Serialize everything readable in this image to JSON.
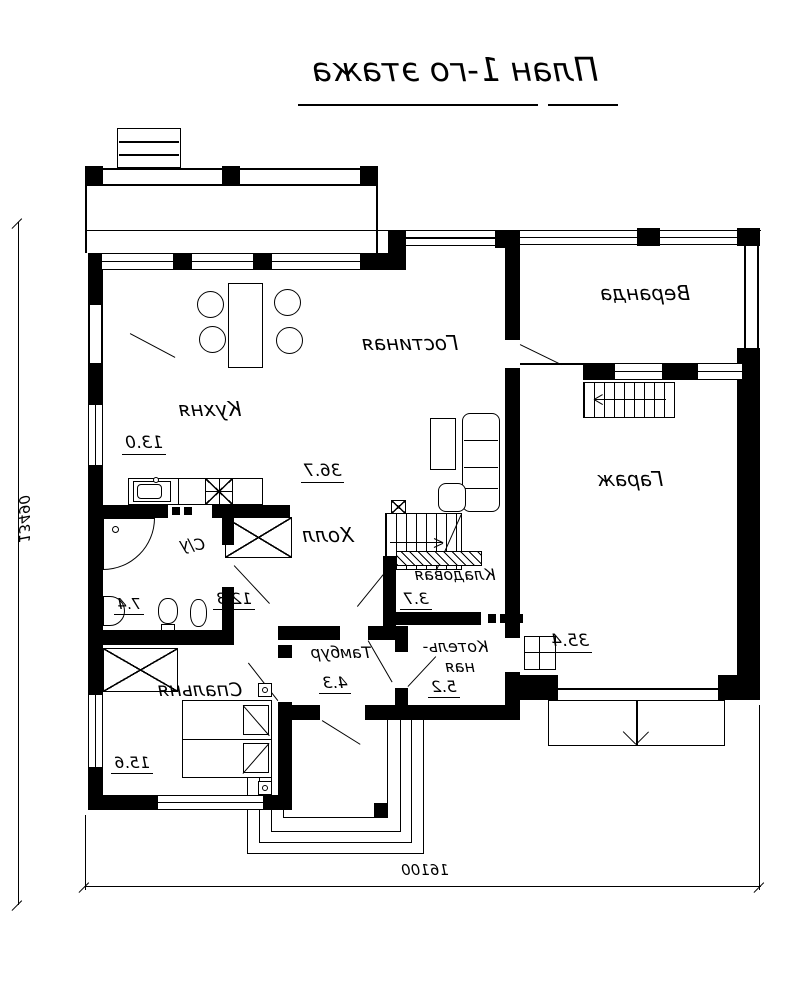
{
  "title": "План 1-го этажа",
  "dimensions": {
    "width": "16100",
    "height": "13490"
  },
  "rooms": {
    "kitchen": {
      "name": "Кухня",
      "area": "13.0"
    },
    "living": {
      "name": "Гостиная",
      "area": "36.7"
    },
    "veranda": {
      "name": "Веранда"
    },
    "garage": {
      "name": "Гараж",
      "area": "35.4"
    },
    "hall": {
      "name": "Холл",
      "area": "12.3"
    },
    "pantry": {
      "name": "Кладовая",
      "area": "3.7"
    },
    "vestibule": {
      "name": "Тамбур",
      "area": "4.3"
    },
    "boiler": {
      "name_line1": "Котель-",
      "name_line2": "ная",
      "area": "5.2"
    },
    "bathroom": {
      "name": "С/у",
      "area": "7.4"
    },
    "bedroom": {
      "name": "Спальня",
      "area": "15.6"
    }
  }
}
